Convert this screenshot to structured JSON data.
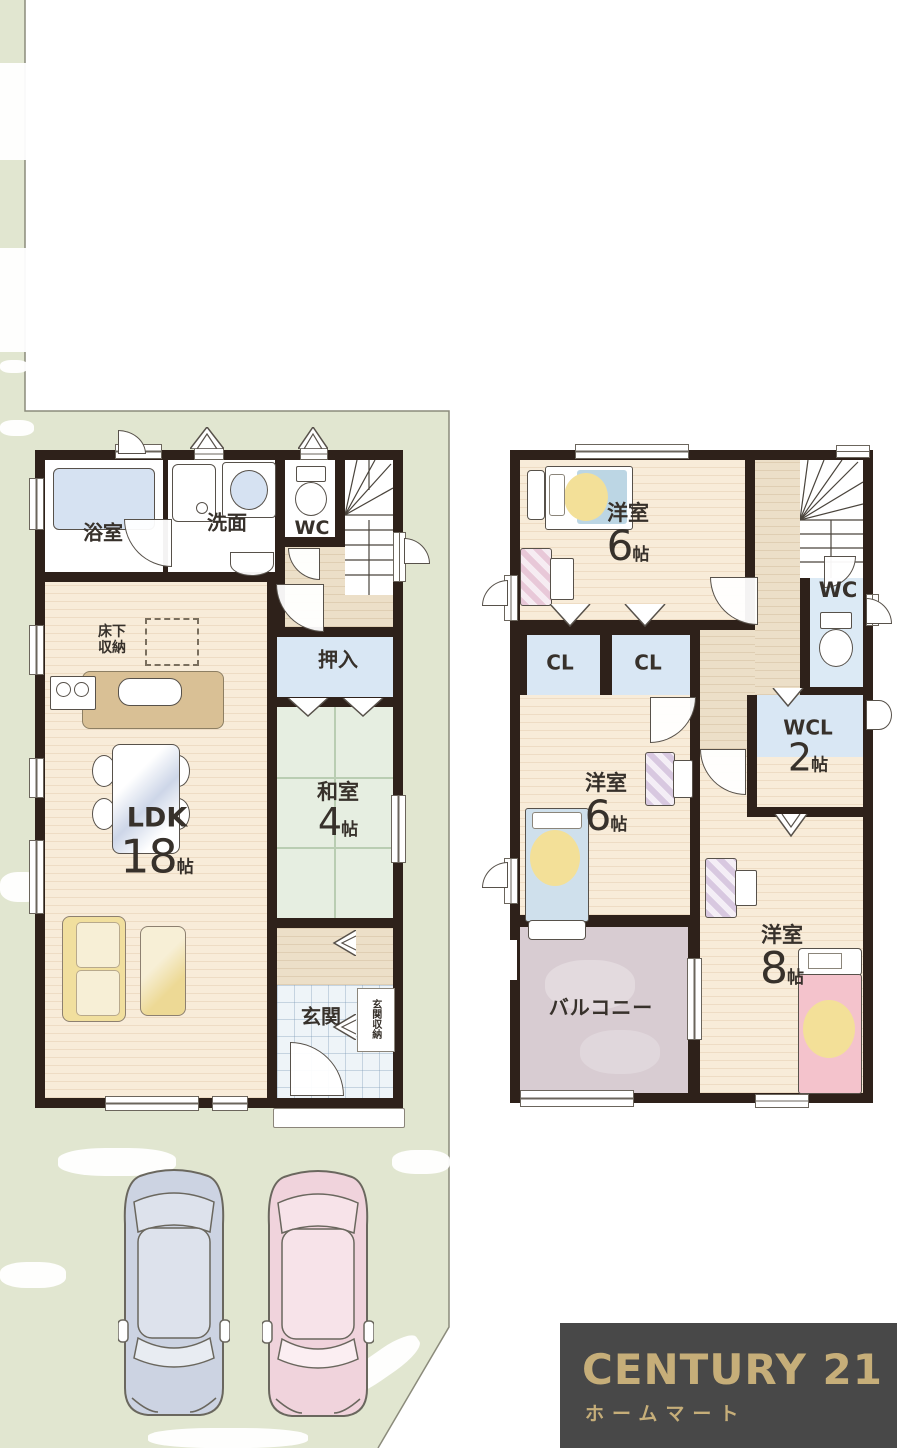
{
  "floor1": {
    "bath": "浴室",
    "washroom": "洗面",
    "wc": "WC",
    "underfloor": "床下収納",
    "closet": "押入",
    "ldk": "LDK",
    "ldk_size": "18",
    "ldk_unit": "帖",
    "washitsu": "和室",
    "washitsu_size": "4",
    "washitsu_unit": "帖",
    "entrance": "玄関",
    "entrance_storage": "玄関収納"
  },
  "floor2": {
    "bedroom_n": "洋室",
    "bedroom_n_size": "6",
    "bedroom_n_unit": "帖",
    "wc": "WC",
    "cl_a": "CL",
    "cl_b": "CL",
    "wcl": "WCL",
    "wcl_size": "2",
    "wcl_unit": "帖",
    "bedroom_w": "洋室",
    "bedroom_w_size": "6",
    "bedroom_w_unit": "帖",
    "bedroom_e": "洋室",
    "bedroom_e_size": "8",
    "bedroom_e_unit": "帖",
    "balcony": "バルコニー"
  },
  "logo": {
    "brand": "CENTURY 21",
    "company": "ホームマート"
  },
  "colors": {
    "lot_green": "#e1e6d0",
    "wall_dark": "#2e211a",
    "wood_floor": "#f8ecd9",
    "hall_beige": "#ecdfc8",
    "tatami_green": "#e6eee1",
    "closet_blue": "#d9e7f4",
    "balcony_mauve": "#d8ccd2",
    "logo_bg": "#484848",
    "logo_gold": "#c6ae79",
    "car_blue": "#ccd3e2",
    "car_pink": "#f0d3dc"
  }
}
